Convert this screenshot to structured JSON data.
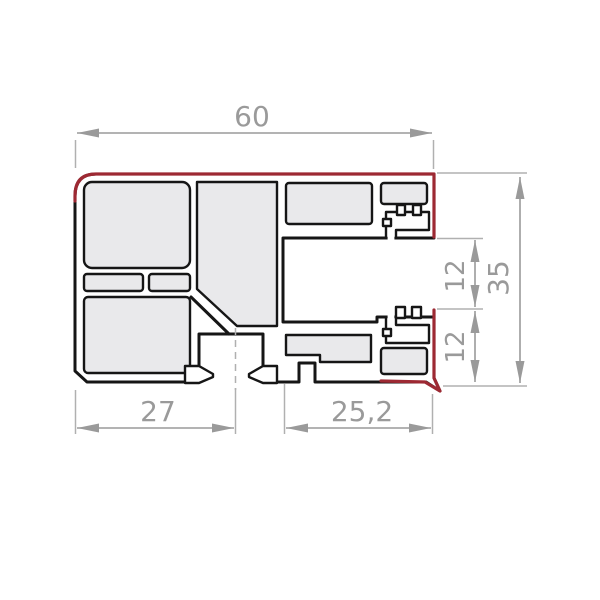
{
  "drawing": {
    "type": "profile-cross-section-technical-drawing",
    "dimensions": {
      "width_top": "60",
      "height_right": "35",
      "segment_upper": "12",
      "segment_lower": "12",
      "bottom_left": "27",
      "bottom_right": "25,2"
    },
    "colors": {
      "highlight": "#9d2933",
      "outline": "#161616",
      "chamber_fill": "#e9e9eb",
      "dimension": "#9a9a9a",
      "extension": "#b0b0b0"
    }
  }
}
